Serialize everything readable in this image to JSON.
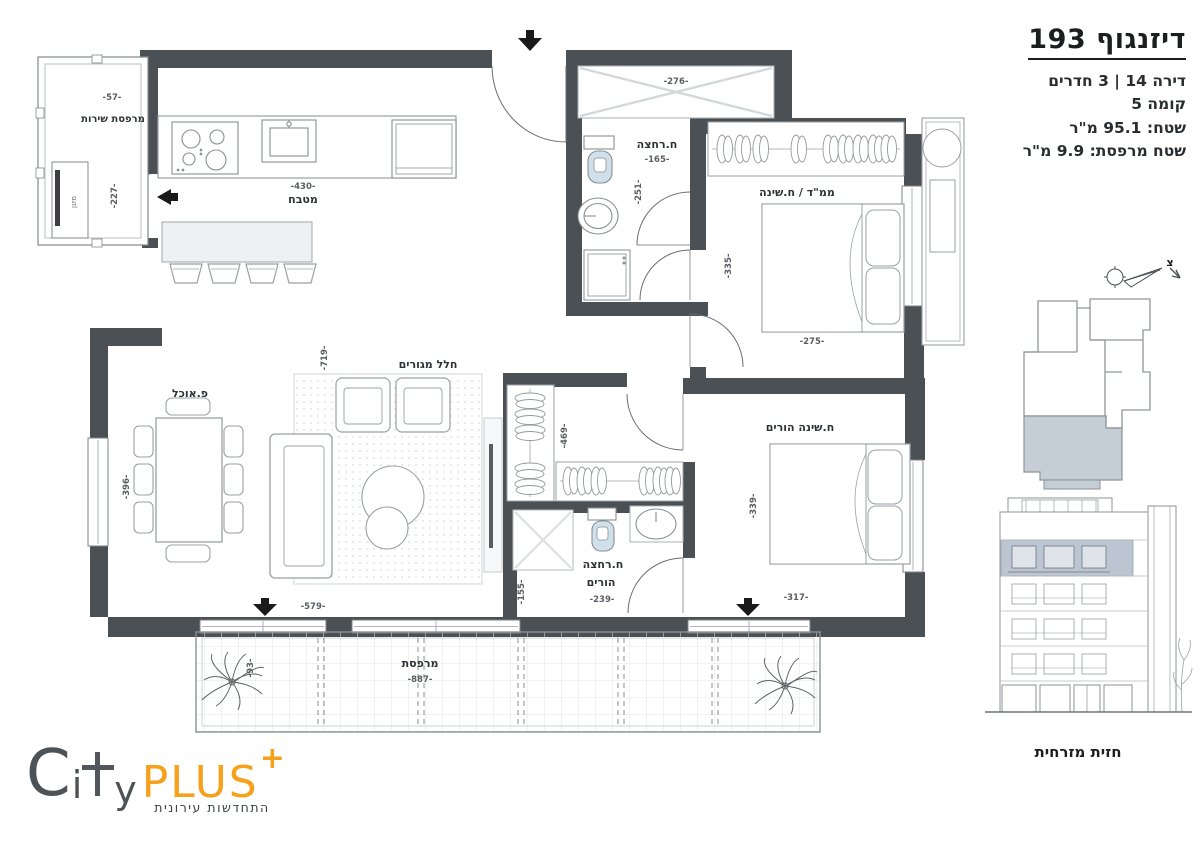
{
  "header": {
    "title": "דיזנגוף 193",
    "apartment_line": "דירה 14 | 3 חדרים",
    "floor_line": "קומה 5",
    "area_line": "שטח: 95.1 מ\"ר",
    "balcony_area_line": "שטח מרפסת: 9.9 מ\"ר"
  },
  "plan": {
    "rooms": {
      "service_balcony": {
        "label": "מרפסת שירות",
        "dim_w": "-57-",
        "dim_h": "-227-",
        "unit_label": "מזגן"
      },
      "kitchen": {
        "label": "מטבח",
        "dim": "-430-"
      },
      "storage": {
        "dim": "-276-"
      },
      "bathroom": {
        "label": "ח.רחצה",
        "dim_w": "-165-",
        "dim_h": "-251-"
      },
      "mamad_bedroom": {
        "label": "ממ\"ד / ח.שינה",
        "dim_h": "-335-",
        "dim_w": "-275-"
      },
      "living": {
        "label": "חלל מגורים",
        "dim_h": "-719-",
        "dim_w": "-579-"
      },
      "dining": {
        "label": "פ.אוכל",
        "dim_h": "-396-"
      },
      "closet": {
        "dim_h": "-469-"
      },
      "parents_bathroom": {
        "label_line1": "ח.רחצה",
        "label_line2": "הורים",
        "dim_w": "-239-",
        "dim_h": "-155-"
      },
      "parents_bedroom": {
        "label": "ח.שינה הורים",
        "dim_h": "-339-",
        "dim_w": "-317-"
      },
      "balcony": {
        "label": "מרפסת",
        "dim_w": "-887-",
        "dim_h": "-93-"
      }
    },
    "north_label": "צ"
  },
  "elevation": {
    "caption": "חזית מזרחית"
  },
  "logo": {
    "letter_c": "C",
    "letter_i": "i",
    "letter_y": "y",
    "word_plus": "PLUS",
    "plus_mark": "+",
    "tagline": "התחדשות עירונית"
  },
  "colors": {
    "wall": "#4b5055",
    "keyplan_highlight": "#c5cdd7",
    "elevation_highlight": "#bcc5d2",
    "fixture_blue": "#cfe0ea",
    "logo_orange": "#f5a11c",
    "logo_gray": "#4d5257"
  }
}
